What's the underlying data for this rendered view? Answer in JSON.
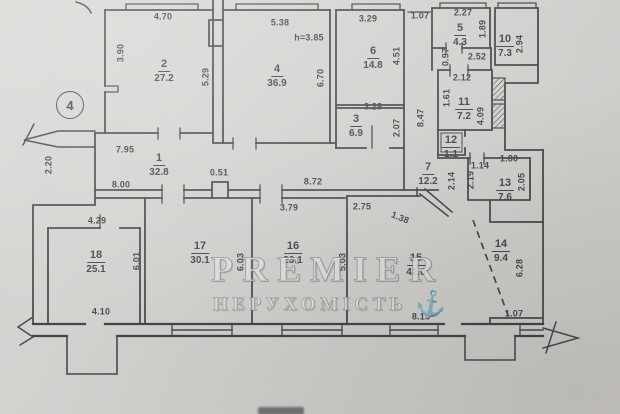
{
  "page": {
    "colors": {
      "paper": "#d6d4d1",
      "ink": "#3a3b40"
    }
  },
  "plan": {
    "section_marker": "4",
    "watermark": {
      "line1": "PREMIER",
      "line2": "НЕРУХОМІСТЬ",
      "logo_icon": "anchor-icon"
    },
    "rooms": [
      {
        "number": "1",
        "area": "32.8",
        "x": 159,
        "y": 149
      },
      {
        "number": "2",
        "area": "27.2",
        "x": 164,
        "y": 55
      },
      {
        "number": "3",
        "area": "6.9",
        "x": 356,
        "y": 110
      },
      {
        "number": "4",
        "area": "36.9",
        "x": 277,
        "y": 60
      },
      {
        "number": "5",
        "area": "4.3",
        "x": 460,
        "y": 19
      },
      {
        "number": "6",
        "area": "14.8",
        "x": 373,
        "y": 42
      },
      {
        "number": "7",
        "area": "12.2",
        "x": 428,
        "y": 158
      },
      {
        "number": "10",
        "area": "7.3",
        "x": 505,
        "y": 30
      },
      {
        "number": "11",
        "area": "7.2",
        "x": 464,
        "y": 93
      },
      {
        "number": "12",
        "area": "1.1",
        "x": 451,
        "y": 131
      },
      {
        "number": "13",
        "area": "7.6",
        "x": 505,
        "y": 174
      },
      {
        "number": "14",
        "area": "9.4",
        "x": 501,
        "y": 235
      },
      {
        "number": "15",
        "area": "42.0",
        "x": 416,
        "y": 249
      },
      {
        "number": "16",
        "area": "23.1",
        "x": 293,
        "y": 237
      },
      {
        "number": "17",
        "area": "30.1",
        "x": 200,
        "y": 237
      },
      {
        "number": "18",
        "area": "25.1",
        "x": 96,
        "y": 246
      }
    ],
    "dimensions": [
      {
        "t": "4.70",
        "x": 163,
        "y": 17
      },
      {
        "t": "3.90",
        "x": 121,
        "y": 53,
        "r": -90
      },
      {
        "t": "5.29",
        "x": 206,
        "y": 77,
        "r": -90
      },
      {
        "t": "5.38",
        "x": 280,
        "y": 23
      },
      {
        "t": "h=3.85",
        "x": 309,
        "y": 38
      },
      {
        "t": "6.70",
        "x": 321,
        "y": 78,
        "r": -90
      },
      {
        "t": "3.29",
        "x": 368,
        "y": 19
      },
      {
        "t": "4.51",
        "x": 397,
        "y": 56,
        "r": -90
      },
      {
        "t": "1.07",
        "x": 420,
        "y": 16
      },
      {
        "t": "2.27",
        "x": 463,
        "y": 13
      },
      {
        "t": "1.89",
        "x": 483,
        "y": 29,
        "r": -90
      },
      {
        "t": "2.52",
        "x": 477,
        "y": 57
      },
      {
        "t": "0.97",
        "x": 446,
        "y": 57,
        "r": -90
      },
      {
        "t": "2.94",
        "x": 520,
        "y": 44,
        "r": -90
      },
      {
        "t": "2.12",
        "x": 462,
        "y": 78
      },
      {
        "t": "1.61",
        "x": 447,
        "y": 98,
        "r": -90
      },
      {
        "t": "4.09",
        "x": 481,
        "y": 116,
        "r": -90
      },
      {
        "t": "8.47",
        "x": 421,
        "y": 118,
        "r": -90
      },
      {
        "t": "3.28",
        "x": 373,
        "y": 107
      },
      {
        "t": "2.07",
        "x": 397,
        "y": 128,
        "r": -90
      },
      {
        "t": "7.95",
        "x": 125,
        "y": 150
      },
      {
        "t": "2.20",
        "x": 49,
        "y": 165,
        "r": -90
      },
      {
        "t": "0.51",
        "x": 219,
        "y": 173
      },
      {
        "t": "8.72",
        "x": 313,
        "y": 182
      },
      {
        "t": "8.00",
        "x": 121,
        "y": 185
      },
      {
        "t": "2.14",
        "x": 452,
        "y": 181,
        "r": -90
      },
      {
        "t": "2.19",
        "x": 471,
        "y": 180,
        "r": -90
      },
      {
        "t": "1.14",
        "x": 480,
        "y": 166
      },
      {
        "t": "1.80",
        "x": 509,
        "y": 159
      },
      {
        "t": "2.05",
        "x": 522,
        "y": 182,
        "r": -90
      },
      {
        "t": "4.29",
        "x": 97,
        "y": 221
      },
      {
        "t": "3.79",
        "x": 289,
        "y": 208
      },
      {
        "t": "2.75",
        "x": 362,
        "y": 207
      },
      {
        "t": "1.38",
        "x": 400,
        "y": 218,
        "r": 22
      },
      {
        "t": "6.01",
        "x": 137,
        "y": 261,
        "r": -90
      },
      {
        "t": "6.03",
        "x": 241,
        "y": 262,
        "r": -90
      },
      {
        "t": "5.03",
        "x": 343,
        "y": 262,
        "r": -90
      },
      {
        "t": "6.28",
        "x": 520,
        "y": 268,
        "r": -90
      },
      {
        "t": "4.10",
        "x": 101,
        "y": 312
      },
      {
        "t": "8.15",
        "x": 421,
        "y": 317
      },
      {
        "t": "1.07",
        "x": 514,
        "y": 314
      }
    ]
  }
}
